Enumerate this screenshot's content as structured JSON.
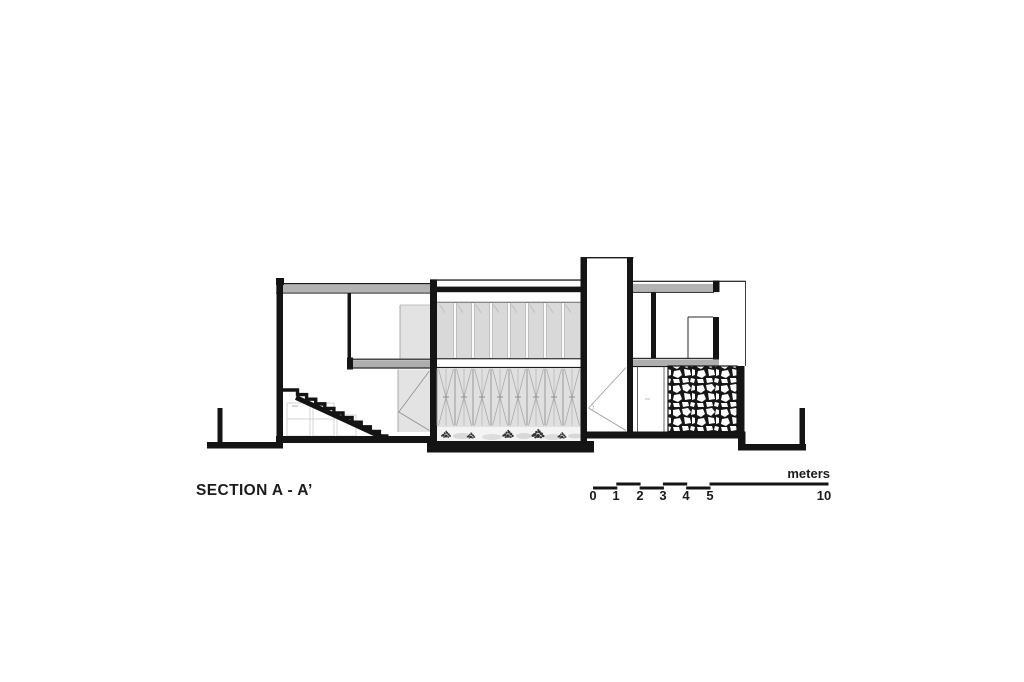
{
  "drawing": {
    "title": "SECTION A - A’",
    "kind": "architectural-section"
  },
  "scale_bar": {
    "unit_label": "meters",
    "tick_labels": [
      "0",
      "1",
      "2",
      "3",
      "4",
      "5",
      "10"
    ]
  },
  "colors": {
    "ink": "#141414",
    "roof_slab_gray": "#b3b3b3",
    "floor_slab_gray": "#aeaeae",
    "glazing_field_gray": "#d9d9d9",
    "elevation_fill_gray": "#e3e3e3",
    "background": "#ffffff"
  }
}
